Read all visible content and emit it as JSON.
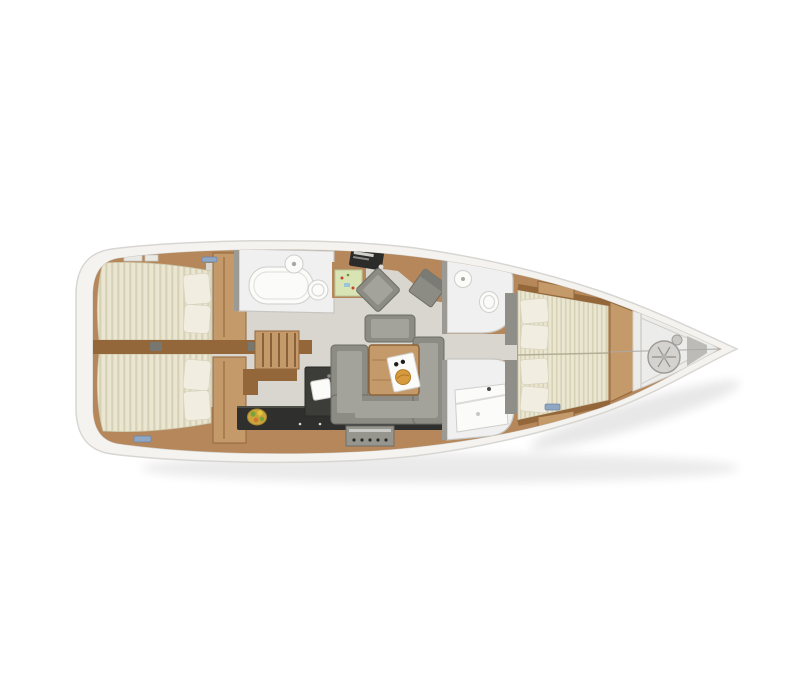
{
  "scene": {
    "name": "sailing-yacht-interior-layout-plan",
    "view": "top-down",
    "orientation": "bow-right",
    "background": "#ffffff"
  },
  "colors": {
    "hull": "#f4f3f0",
    "hullEdge": "#d7d6d2",
    "deckLine": "#cfceca",
    "wood": "#b5875a",
    "woodLight": "#c59a6b",
    "woodDark": "#936739",
    "floor": "#d9d6cf",
    "floorDark": "#8f8e89",
    "mattress": "#eae6d1",
    "mattressStripe": "#d7d2b6",
    "pillow": "#f1eee1",
    "sofa": "#8c8c84",
    "sofaLight": "#a3a39b",
    "sofaDark": "#6d6d66",
    "counter": "#2f2f2d",
    "bathroom": "#eff0ef",
    "fixture": "#fbfbfa",
    "fixtureEdge": "#cfcecb",
    "wall": "#9b9a95",
    "chart": "#d9e4b4",
    "hatchBlue": "#8fa6c4",
    "food": "#d89a3e",
    "fruitBowl": "#caa53c",
    "fruitGreen": "#7aa33a",
    "fruitYellow": "#e2c63e",
    "bowPanel": "#ececea",
    "metal": "#d4d3d0"
  },
  "areas": [
    {
      "id": "aft-cabin-port",
      "contents": [
        "double-berth",
        "pillows",
        "wardrobe"
      ]
    },
    {
      "id": "aft-cabin-starboard",
      "contents": [
        "double-berth",
        "pillows",
        "wardrobe"
      ]
    },
    {
      "id": "aft-head",
      "contents": [
        "shower",
        "washbasin",
        "toilet"
      ]
    },
    {
      "id": "nav-station",
      "contents": [
        "chart-map",
        "instruments",
        "chair"
      ]
    },
    {
      "id": "companionway",
      "contents": [
        "stairs",
        "locker"
      ]
    },
    {
      "id": "salon",
      "contents": [
        "u-sofa",
        "ottoman",
        "table",
        "serving-tray"
      ]
    },
    {
      "id": "galley",
      "contents": [
        "counter",
        "sink-island",
        "oven",
        "fruit-bowl"
      ]
    },
    {
      "id": "forward-head-port",
      "contents": [
        "washbasin",
        "toilet"
      ]
    },
    {
      "id": "forward-head-starboard",
      "contents": [
        "shower-tray"
      ]
    },
    {
      "id": "forward-cabin",
      "contents": [
        "double-berth",
        "pillows",
        "lockers",
        "shelves"
      ]
    },
    {
      "id": "bow-locker",
      "contents": [
        "anchor-windlass"
      ]
    }
  ]
}
